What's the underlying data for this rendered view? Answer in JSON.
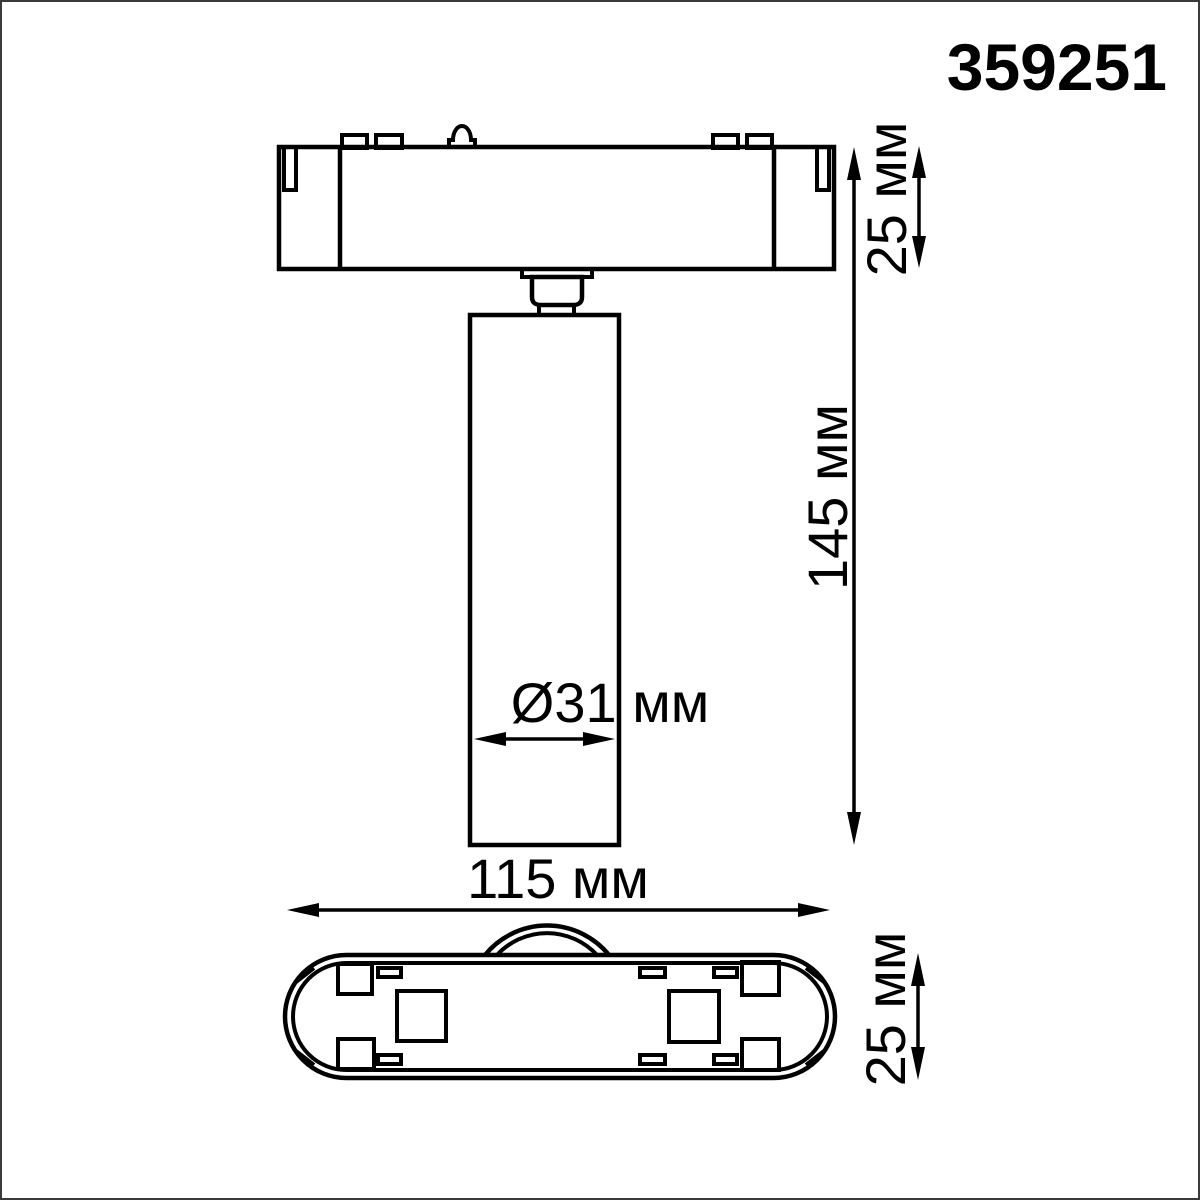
{
  "product": {
    "code": "359251"
  },
  "dimensions": {
    "side_view": {
      "track_mount_height": "25 мм",
      "total_height": "145 мм",
      "body_diameter": "Ø31 мм"
    },
    "bottom_view": {
      "overall_length": "115 мм",
      "base_width": "25 мм"
    }
  },
  "colors": {
    "line": "#000000",
    "background": "#ffffff",
    "frame": "#3a3a3a"
  }
}
